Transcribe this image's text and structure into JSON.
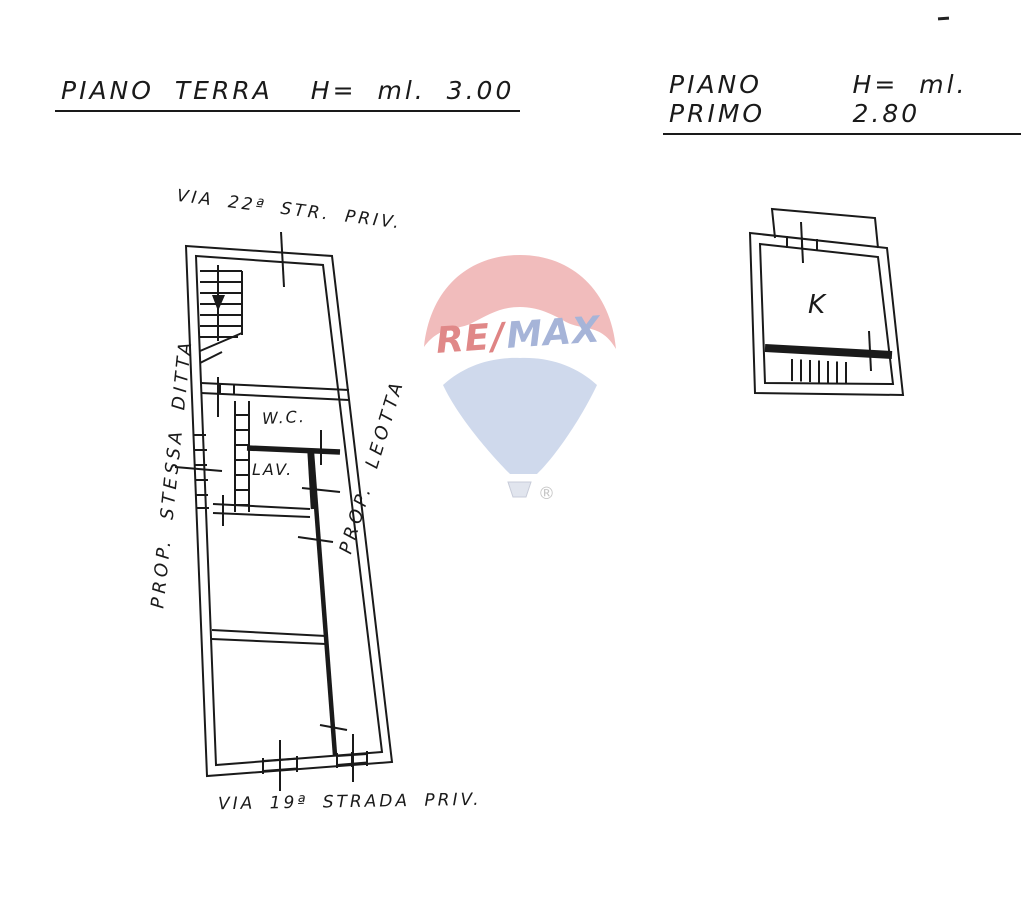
{
  "document": {
    "type": "floor-plan-scan",
    "background": "#ffffff",
    "ink_color": "#1a1a1a"
  },
  "titles": {
    "ground_floor": {
      "label": "PIANO TERRA",
      "height": "H= ml. 3.00"
    },
    "first_floor": {
      "label": "PIANO PRIMO",
      "height": "H= ml. 2.80"
    }
  },
  "ground_floor_plan": {
    "street_top": "VIA 22ª STR. PRIV.",
    "street_bottom": "VIA 19ª STRADA PRIV.",
    "property_left": "PROP. STESSA DITTA",
    "property_right": "PROP. LEOTTA",
    "rooms": {
      "wc": "W.C.",
      "laundry": "LAV."
    }
  },
  "first_floor_plan": {
    "rooms": {
      "kitchen": "K"
    }
  },
  "watermark": {
    "brand_re": "RE",
    "brand_slash": "/",
    "brand_max": "MAX",
    "registered": "®",
    "colors": {
      "canopy_red": "#f1bcbc",
      "text_red": "#e08888",
      "text_blue": "#a6b4d8",
      "cone_blue": "#cfd9ec",
      "basket_gray": "#e1e5ee",
      "registered_gray": "#c6c6c6"
    }
  },
  "marks": {
    "corner_dash_color": "#222222"
  }
}
